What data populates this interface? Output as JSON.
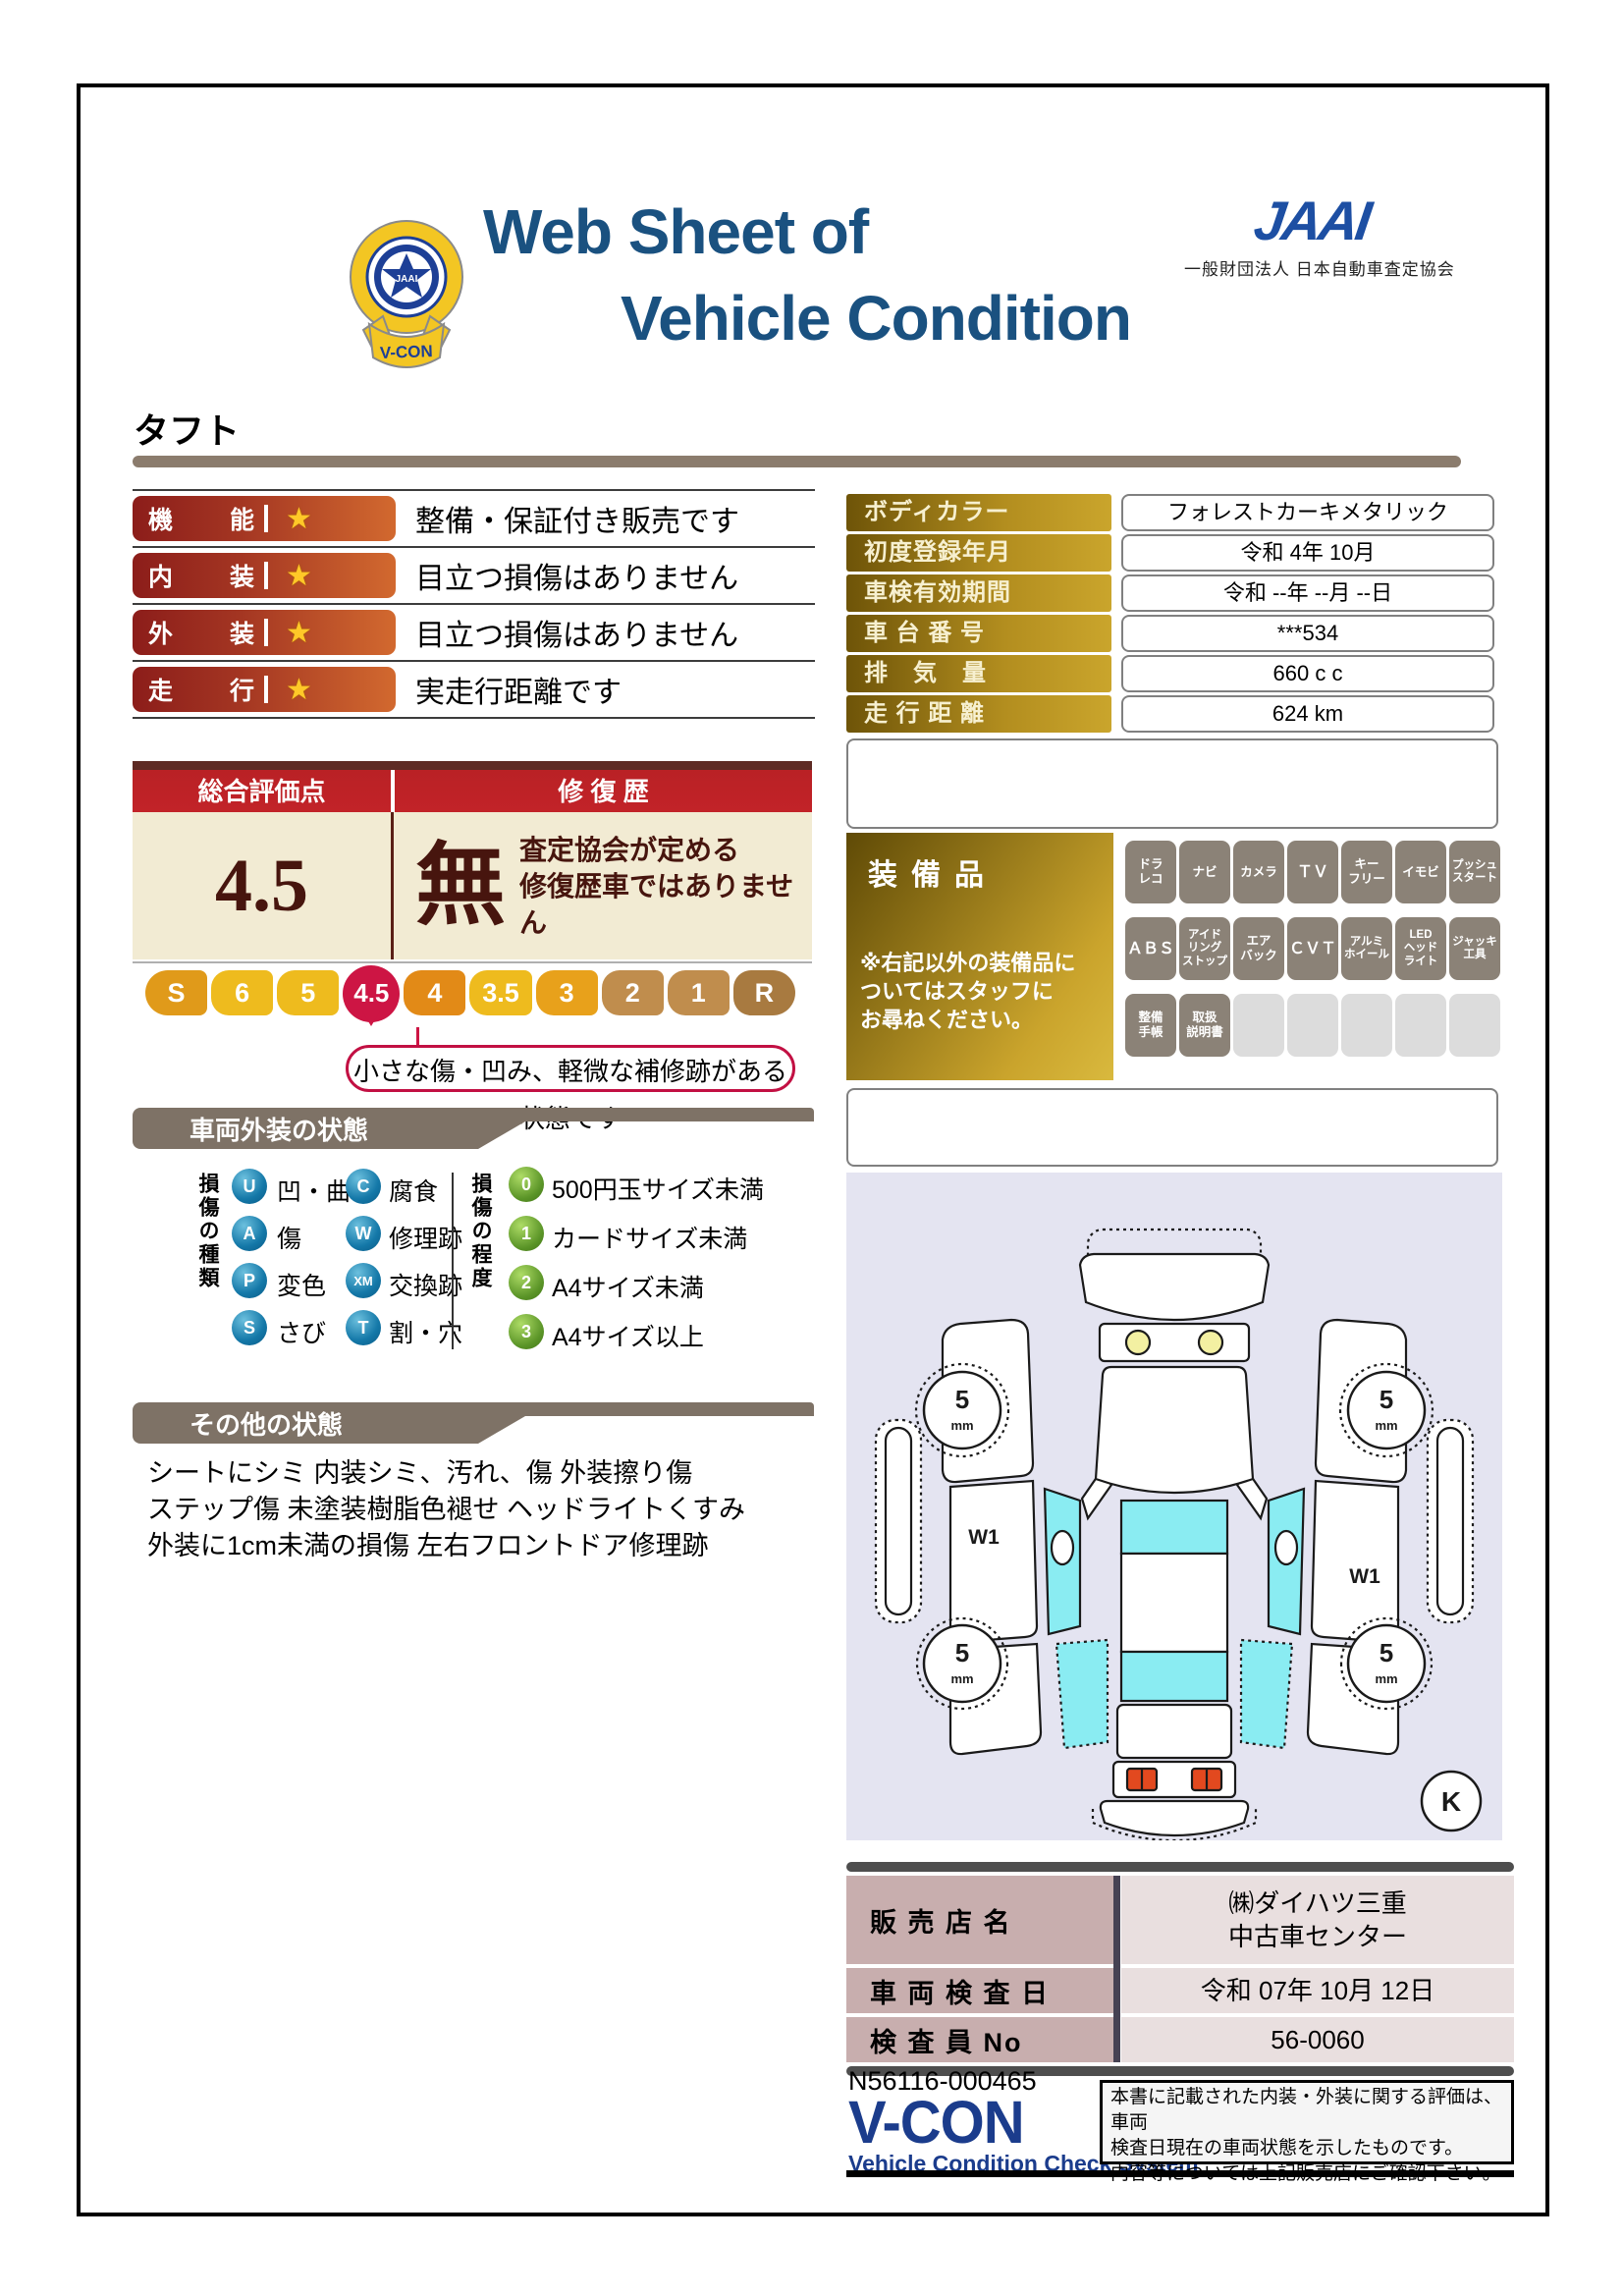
{
  "colors": {
    "title_blue": "#1a5180",
    "jaai_blue": "#1d4fa3",
    "rating_pill_red": "#8c1d1a",
    "gold_label": "#b38e1f",
    "overall_header_red": "#c0202a",
    "score_maroon": "#47150e",
    "scale_active_crimson": "#cd1544",
    "glass_cyan": "#8aecf2",
    "diagram_bg": "#e4e4f1",
    "banner_taupe": "#7e7266",
    "dealer_label_pink": "#c8aeae",
    "vcon_navy": "#1b3c8c"
  },
  "header": {
    "title1": "Web Sheet of",
    "title2": "Vehicle Condition",
    "org_logo": "JAAI",
    "org_name": "一般財団法人 日本自動車査定協会",
    "badge": {
      "center": "JAAI",
      "ring": "VEHICLE CONDITION CHECK SYSTEM",
      "ribbon": "V-CON"
    }
  },
  "vehicle_name": "タフト",
  "ratings": [
    {
      "label": "機能",
      "star": "★",
      "comment": "整備・保証付き販売です"
    },
    {
      "label": "内装",
      "star": "★",
      "comment": "目立つ損傷はありません"
    },
    {
      "label": "外装",
      "star": "★",
      "comment": "目立つ損傷はありません"
    },
    {
      "label": "走行",
      "star": "★",
      "comment": "実走行距離です"
    }
  ],
  "info": [
    {
      "label": "ボディカラー",
      "value": "フォレストカーキメタリック"
    },
    {
      "label": "初度登録年月",
      "value": "令和 4年 10月"
    },
    {
      "label": "車検有効期間",
      "value": "令和 --年 --月 --日"
    },
    {
      "label": "車 台 番 号",
      "value": "***534"
    },
    {
      "label": "排　気　量",
      "value": "660 c c"
    },
    {
      "label": "走 行 距 離",
      "value": "624 km"
    }
  ],
  "overall": {
    "header_left": "総合評価点",
    "header_right": "修 復 歴",
    "score": "4.5",
    "repair": "無",
    "repair_note": "査定協会が定める\n修復歴車ではありません",
    "scale": [
      {
        "label": "S",
        "color": "#e09a1a"
      },
      {
        "label": "6",
        "color": "#eebb1e"
      },
      {
        "label": "5",
        "color": "#eebb1e"
      },
      {
        "label": "4.5",
        "color": "#cd1544",
        "active": true
      },
      {
        "label": "4",
        "color": "#e28a17"
      },
      {
        "label": "3.5",
        "color": "#eebb1e"
      },
      {
        "label": "3",
        "color": "#e8a11b"
      },
      {
        "label": "2",
        "color": "#c08d4d"
      },
      {
        "label": "1",
        "color": "#c08d4d"
      },
      {
        "label": "R",
        "color": "#a87a40"
      }
    ],
    "callout": "小さな傷・凹み、軽微な補修跡がある状態です"
  },
  "equipment": {
    "title": "装備品",
    "note": "※右記以外の装備品に\nついてはスタッフに\nお尋ねください。",
    "badges": [
      "ドラ\nレコ",
      "ナビ",
      "カメラ",
      "ＴＶ",
      "キー\nフリー",
      "イモビ",
      "プッシュ\nスタート",
      "ＡＢＳ",
      "アイド\nリング\nストップ",
      "エア\nバック",
      "ＣＶＴ",
      "アルミ\nホイール",
      "LED\nヘッド\nライト",
      "ジャッキ\n工具",
      "整備\n手帳",
      "取扱\n説明書"
    ]
  },
  "exterior": {
    "title": "車両外装の状態",
    "kind_title": "損傷の種類",
    "kinds": [
      {
        "code": "U",
        "label": "凹・曲"
      },
      {
        "code": "A",
        "label": "傷"
      },
      {
        "code": "P",
        "label": "変色"
      },
      {
        "code": "S",
        "label": "さび"
      },
      {
        "code": "C",
        "label": "腐食"
      },
      {
        "code": "W",
        "label": "修理跡"
      },
      {
        "code": "XM",
        "label": "交換跡"
      },
      {
        "code": "T",
        "label": "割・穴"
      }
    ],
    "degree_title": "損傷の程度",
    "degrees": [
      {
        "code": "0",
        "label": "500円玉サイズ未満"
      },
      {
        "code": "1",
        "label": "カードサイズ未満"
      },
      {
        "code": "2",
        "label": "A4サイズ未満"
      },
      {
        "code": "3",
        "label": "A4サイズ以上"
      }
    ]
  },
  "other": {
    "title": "その他の状態",
    "text": "シートにシミ 内装シミ、汚れ、傷 外装擦り傷\nステップ傷 未塗装樹脂色褪せ ヘッドライトくすみ\n外装に1cm未満の損傷 左右フロントドア修理跡"
  },
  "diagram": {
    "tread_value": "5",
    "tread_unit": "mm",
    "door_mark": "W1",
    "corner_mark": "K"
  },
  "dealer": [
    {
      "label": "販 売 店 名",
      "value": "㈱ダイハツ三重\n中古車センター"
    },
    {
      "label": "車 両 検 査 日",
      "value": "令和 07年 10月 12日"
    },
    {
      "label": "検 査 員 No",
      "value": "56-0060"
    }
  ],
  "footer": {
    "doc_no": "N56116-000465",
    "logo": "V-CON",
    "logo_sub": "Vehicle Condition Check System",
    "disclaimer": "本書に記載された内装・外装に関する評価は、車両\n検査日現在の車両状態を示したものです。\n内容等については上記販売店にご確認下さい。"
  }
}
